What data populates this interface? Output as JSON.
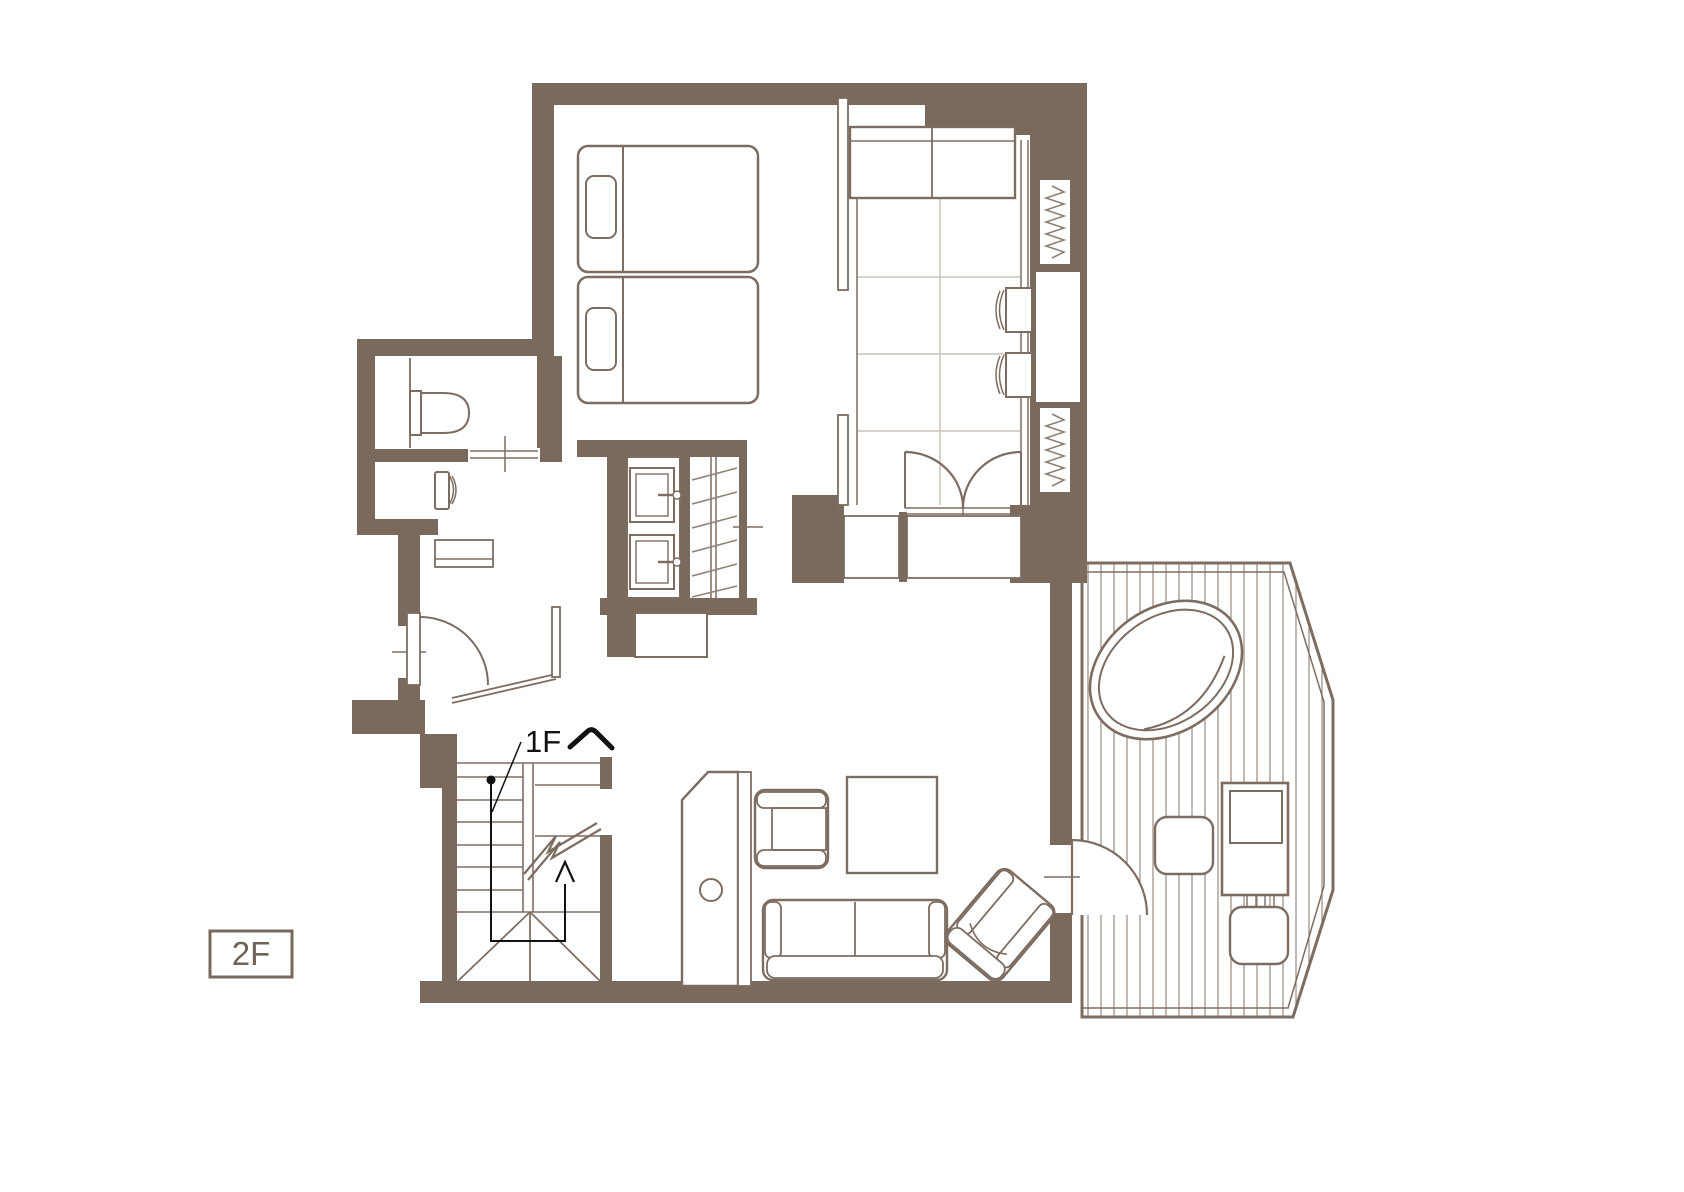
{
  "floor": {
    "badge_label": "2F",
    "stairs_label": "1Fへ",
    "stairs_label_latin": "1F"
  },
  "palette": {
    "wall": "#7a6a5e",
    "furniture_line": "#7d6d61",
    "light_line": "#8e8074",
    "tatami_grid": "#ccc4bb",
    "deck_plank": "#9a8b7e",
    "annotation": "#111111",
    "background": "#ffffff"
  },
  "elements": [
    "exterior-walls",
    "bedroom",
    "twin-bed",
    "twin-bed",
    "tatami-room",
    "tatami-chest",
    "floor-chair",
    "floor-chair",
    "coil-window",
    "coil-window",
    "double-swing-doors",
    "storage-closets",
    "toilet-room",
    "toilet",
    "washlet-room",
    "washlet",
    "sliding-door",
    "vanity-counter",
    "sink",
    "sink",
    "wardrobe-closet",
    "entry-hall",
    "hinged-door",
    "staircase",
    "stair-route-arrow",
    "living-room",
    "tv-cabinet",
    "armchair",
    "coffee-table",
    "sofa",
    "lounge-chair",
    "deck-terrace",
    "open-air-bath",
    "deck-stool",
    "deck-stool",
    "deck-table",
    "deck-door"
  ]
}
